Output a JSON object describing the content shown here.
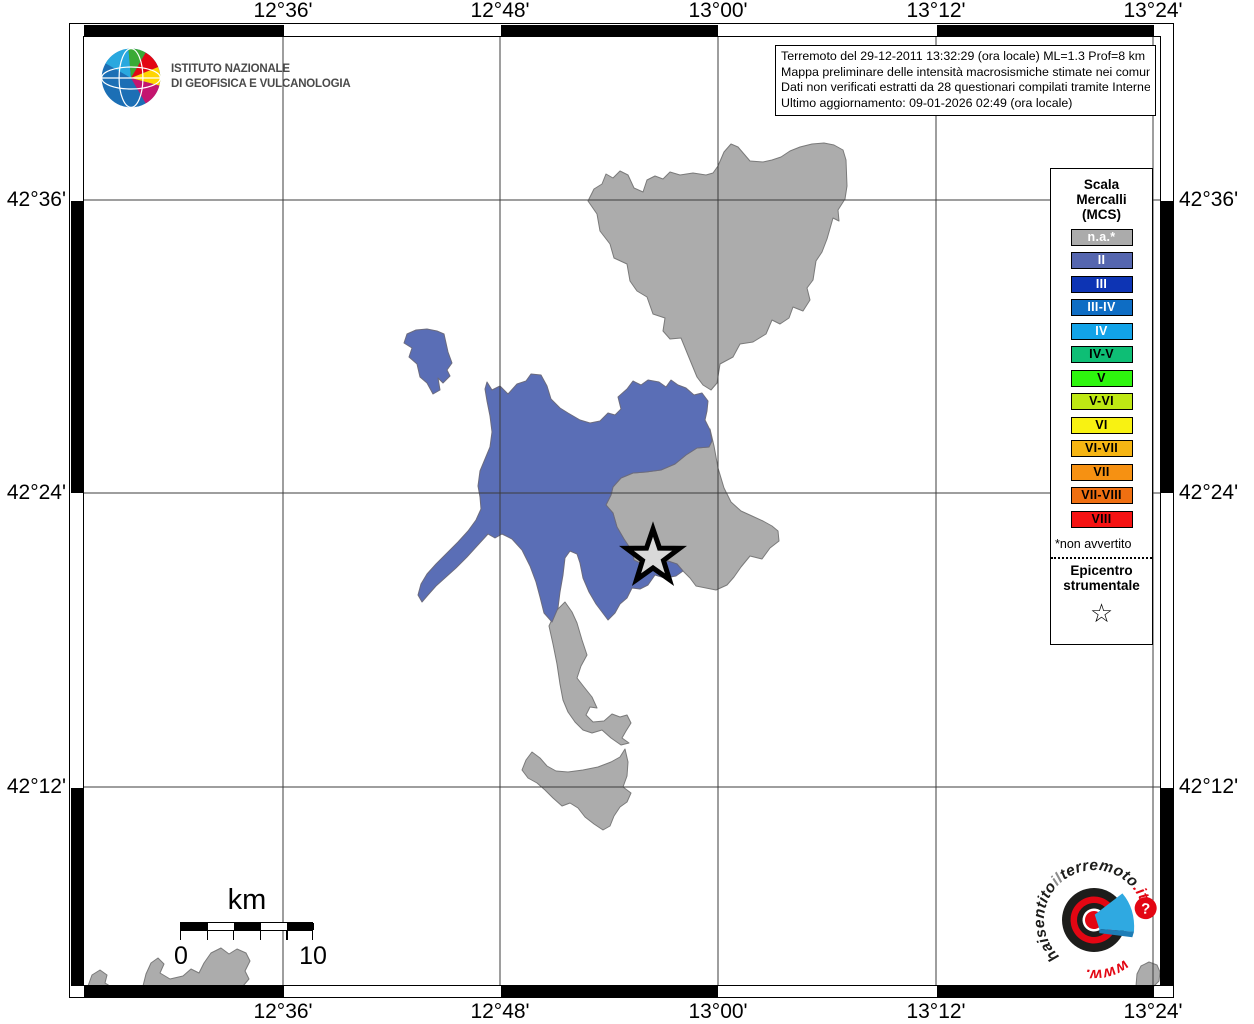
{
  "info_box": {
    "line1": "Terremoto del 29-12-2011 13:32:29 (ora locale) ML=1.3 Prof=8 km",
    "line2": "Mappa preliminare delle intensità macrosismiche stimate nei comuni",
    "line3": "Dati non verificati estratti da 28 questionari compilati tramite Internet.",
    "line4": "Ultimo aggiornamento: 09-01-2026 02:49 (ora locale)"
  },
  "ingv_logo": {
    "name_line1": "ISTITUTO NAZIONALE",
    "name_line2": "DI GEOFISICA E VULCANOLOGIA"
  },
  "axes": {
    "top": [
      "12°36'",
      "12°48'",
      "13°00'",
      "13°12'",
      "13°24'"
    ],
    "bottom": [
      "12°36'",
      "12°48'",
      "13°00'",
      "13°12'",
      "13°24'"
    ],
    "left": [
      "42°36'",
      "42°24'",
      "42°12'"
    ],
    "right": [
      "42°36'",
      "42°24'",
      "42°12'"
    ]
  },
  "legend": {
    "title_line1": "Scala",
    "title_line2": "Mercalli",
    "title_line3": "(MCS)",
    "items": [
      {
        "label": "n.a.*",
        "color": "#ABABAB",
        "text_color": "#FFFFFF"
      },
      {
        "label": "II",
        "color": "#5566AF",
        "text_color": "#FFFFFF"
      },
      {
        "label": "III",
        "color": "#0D34B4",
        "text_color": "#FFFFFF"
      },
      {
        "label": "III-IV",
        "color": "#0E6DC4",
        "text_color": "#FFFFFF"
      },
      {
        "label": "IV",
        "color": "#12A3E8",
        "text_color": "#FFFFFF"
      },
      {
        "label": "IV-V",
        "color": "#0EBE75",
        "text_color": "#000000"
      },
      {
        "label": "V",
        "color": "#2EF50E",
        "text_color": "#000000"
      },
      {
        "label": "V-VI",
        "color": "#BEE813",
        "text_color": "#000000"
      },
      {
        "label": "VI",
        "color": "#F8F212",
        "text_color": "#000000"
      },
      {
        "label": "VI-VII",
        "color": "#F6B513",
        "text_color": "#000000"
      },
      {
        "label": "VII",
        "color": "#F69112",
        "text_color": "#000000"
      },
      {
        "label": "VII-VIII",
        "color": "#EF6F11",
        "text_color": "#000000"
      },
      {
        "label": "VIII",
        "color": "#F51313",
        "text_color": "#000000"
      }
    ],
    "footnote": "*non avvertito",
    "epicenter_line1": "Epicentro",
    "epicenter_line2": "strumentale",
    "epicenter_symbol": "☆"
  },
  "scale_bar": {
    "unit": "km",
    "start_label": "0",
    "end_label": "10"
  },
  "map": {
    "colors": {
      "felt": "#5A6EB6",
      "not_felt": "#ACACAC",
      "outline": "#7A7A7A",
      "grid": "#3C3C3C",
      "star_fill": "#D9D9D9"
    }
  },
  "site_logo": {
    "text_www": "www.",
    "text_hai": "haisentito",
    "text_il": "il",
    "text_terremoto": "terremoto",
    "text_dot_it": ".it",
    "question_mark": "?",
    "red": "#E30613",
    "blue": "#2FA9E1"
  }
}
